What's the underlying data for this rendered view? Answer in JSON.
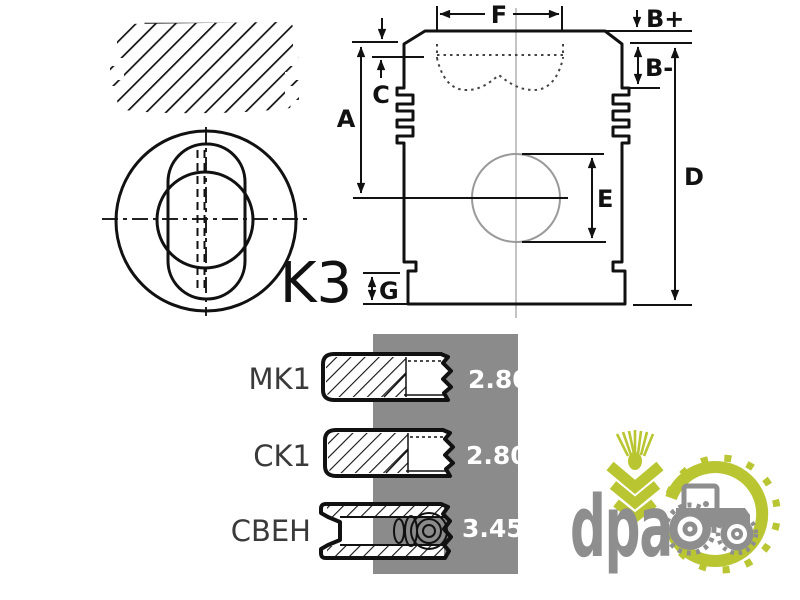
{
  "title": "Piston and ring set technical drawing",
  "part_code": "K3",
  "dimensions": {
    "f": "F",
    "b_plus": "B+",
    "b_minus": "B-",
    "c": "C",
    "a": "A",
    "d": "D",
    "e": "E",
    "g": "G"
  },
  "ring_table": {
    "rows": [
      {
        "label": "MK1",
        "value": "2.80"
      },
      {
        "label": "CK1",
        "value": "2.80"
      },
      {
        "label": "CBEH",
        "value": "3.45"
      }
    ]
  },
  "logo": {
    "text": "dpa"
  },
  "icons": [
    "wheat-icon",
    "tractor-icon",
    "tire-ring-icon"
  ],
  "colors": {
    "panel_gray": "#8b8b8b",
    "logo_green": "#b9c531",
    "logo_gray": "#8e8e8e",
    "line_black": "#111111",
    "value_white": "#ffffff"
  }
}
